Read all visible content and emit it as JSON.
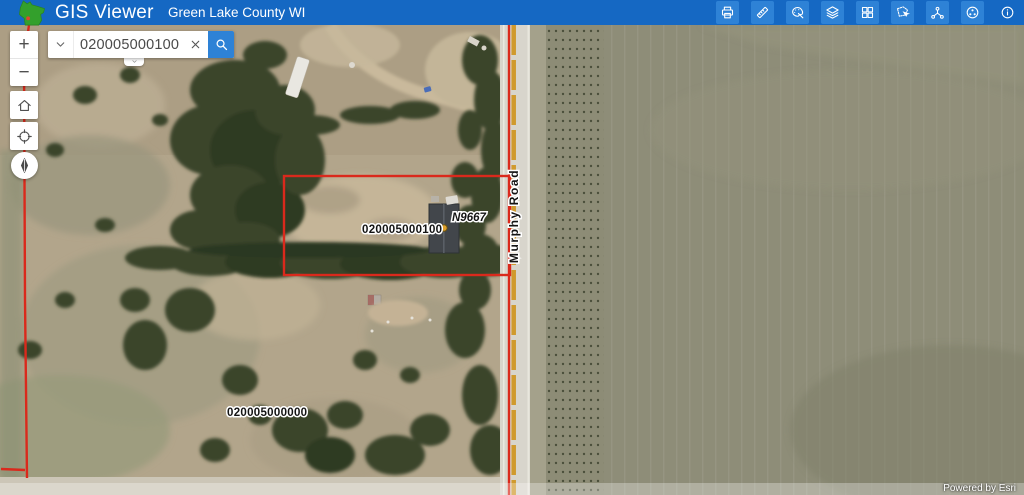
{
  "header": {
    "app_title": "GIS Viewer",
    "subtitle": "Green Lake County WI",
    "logo_icon": "wisconsin-state-logo",
    "toolbar_icons": [
      "print",
      "measure",
      "draw",
      "layers",
      "basemap",
      "select",
      "link-chart",
      "share",
      "info"
    ]
  },
  "search": {
    "value": "020005000100",
    "dropdown_icon": "chevron-down",
    "clear_icon": "close-x",
    "submit_icon": "magnifier"
  },
  "controls": {
    "zoom_in_label": "+",
    "zoom_out_label": "−",
    "home_icon": "home",
    "locate_icon": "crosshair",
    "compass_icon": "north-needle"
  },
  "map_labels": {
    "selected_parcel": "020005000100",
    "address_point": "N9667",
    "road_name": "Murphy Road",
    "adjacent_parcel": "020005000000"
  },
  "colors": {
    "header_bg": "#1568c3",
    "toolbar_button_bg": "#2e82d6",
    "parcel_line": "#da291c",
    "address_dot": "#dfa02b",
    "logo_green": "#33a02c"
  },
  "attribution": "Powered by Esri"
}
